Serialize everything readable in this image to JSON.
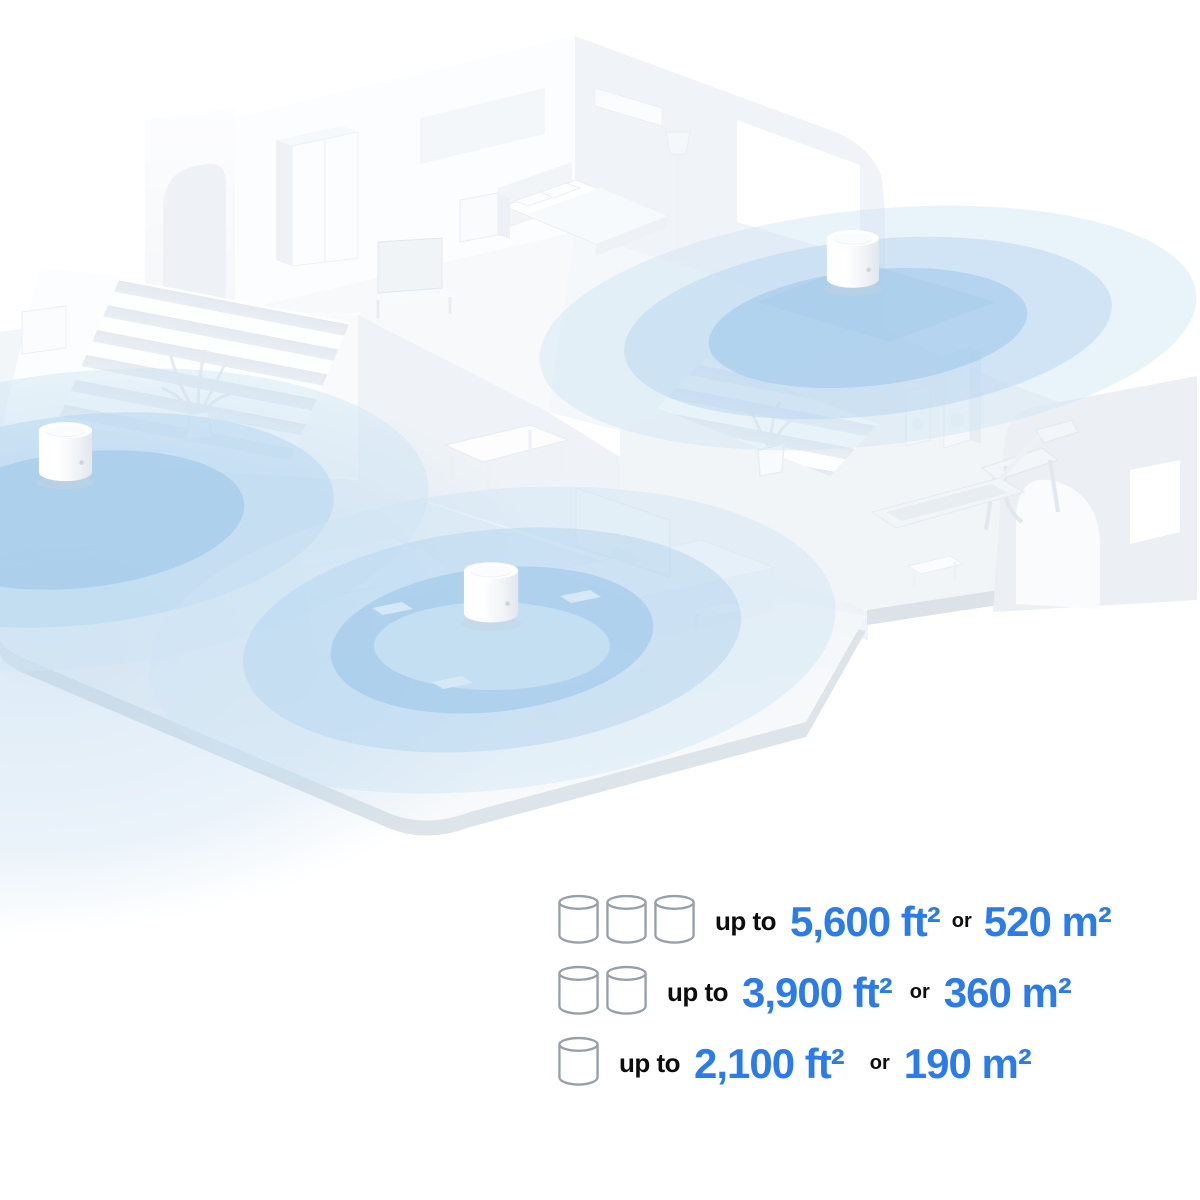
{
  "page": {
    "background": "#ffffff"
  },
  "scene": {
    "kind": "isometric-home-wifi-coverage-illustration",
    "mesh_units": [
      {
        "id": "deco-unit-left",
        "location": "left-hall-floor"
      },
      {
        "id": "deco-unit-upper-right",
        "location": "upper-floor-landing"
      },
      {
        "id": "deco-unit-center",
        "location": "living-room-table"
      }
    ],
    "coverage_colors": {
      "inner": "#9cc6ea",
      "middle": "#b7d6ef",
      "outer": "#cfe4f5",
      "wash": "#aecfeb"
    }
  },
  "legend": {
    "accent_color": "#2b7ce9",
    "text_color": "#0d0d0d",
    "rows": [
      {
        "unit_count": 3,
        "prefix": "up to",
        "imperial": "5,600 ft²",
        "conjunction": "or",
        "metric": "520 m²"
      },
      {
        "unit_count": 2,
        "prefix": "up to",
        "imperial": "3,900 ft²",
        "conjunction": "or",
        "metric": "360 m²"
      },
      {
        "unit_count": 1,
        "prefix": "up to",
        "imperial": "2,100 ft²",
        "conjunction": "or",
        "metric": "190 m²"
      }
    ]
  }
}
